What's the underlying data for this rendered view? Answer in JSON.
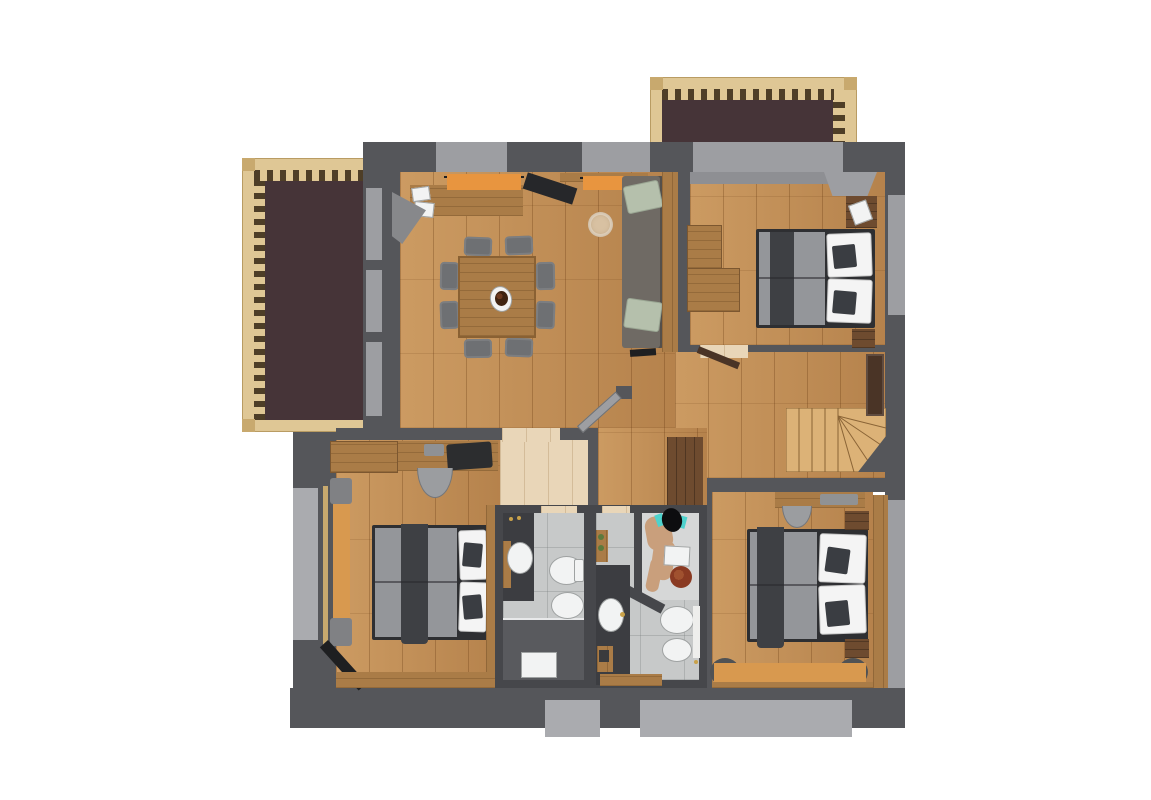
{
  "palette": {
    "canvas_white": "#ffffff",
    "wall_dark": "#55565a",
    "wall_light": "#9d9ea2",
    "ext_light": "#aaabaf",
    "balcony_brown": "#463438",
    "balcony_frame": "#dfc795",
    "balcony_post": "#c8a96e",
    "baluster_dark": "#4e3e27",
    "floor_oak": "#c28d54",
    "floor_pale": "#e9d6b8",
    "furn_wood": "#aa7c47",
    "furn_wood_dark": "#6e4b2f",
    "stairs_wood": "#dcb277",
    "stairs_line": "#8a6436",
    "tile_light": "#c7c9c9",
    "tile_bright": "#d6d7d7",
    "bath_dark": "#46474b",
    "shower_floor": "#595a5e",
    "duvet_gray": "#94969a",
    "runner_dark": "#3e4044",
    "pillow_white": "#f4f4f4",
    "cushion_dark": "#3a3d42",
    "bedframe_dark": "#2e2f32",
    "chair_gray": "#6e7073",
    "chair_light": "#9b9da0",
    "sofa_gray": "#6f6a64",
    "pillow_sage": "#b5c0ac",
    "curtain_orange": "#e8953f",
    "bench_orange": "#d8994f",
    "fixture_white": "#f2f3f3",
    "skin": "#c99f7c",
    "teal": "#4ed2cd",
    "hair_red": "#8a3a22",
    "gold": "#c9a24a",
    "ink": "#1e1f21",
    "door_brown": "#4a3426",
    "pouf_tan": "#d8c1a2"
  },
  "floorplan": {
    "rooms": [
      {
        "name": "living-dining-room"
      },
      {
        "name": "bedroom-top-right"
      },
      {
        "name": "bedroom-bottom-left"
      },
      {
        "name": "bedroom-bottom-right"
      },
      {
        "name": "bathroom-left"
      },
      {
        "name": "bathroom-right"
      },
      {
        "name": "hallway"
      },
      {
        "name": "dressing-vestibule"
      },
      {
        "name": "balcony-top"
      },
      {
        "name": "balcony-left"
      },
      {
        "name": "staircase"
      }
    ],
    "furniture": [
      "dining-table-with-8-chairs",
      "table-centerpiece",
      "sideboard-window-bench",
      "orange-curtains",
      "corner-armchair",
      "wall-tv-panel",
      "sofa",
      "floor-pouf",
      "double-bed-with-pillows-x3",
      "nightstands",
      "wardrobes",
      "desks",
      "desk-chairs",
      "window-benches",
      "washbasins",
      "toilets",
      "bidets",
      "showers",
      "shower-person-figures",
      "winder-staircase",
      "interior-doors"
    ]
  }
}
